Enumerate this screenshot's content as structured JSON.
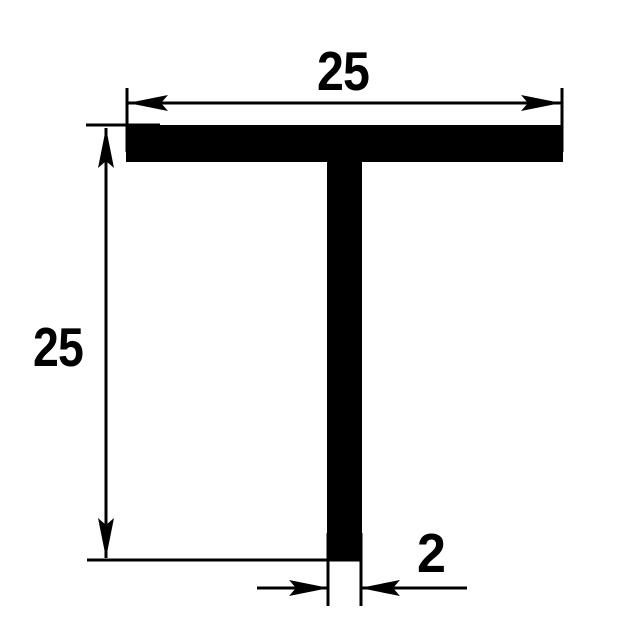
{
  "drawing": {
    "title": "T-profile cross-section technical drawing",
    "colors": {
      "ink": "#000000",
      "paper": "#ffffff"
    },
    "profile": {
      "shape": "T-section",
      "orientation": "flange on top, stem down"
    },
    "dimensions": {
      "width": {
        "label": "25",
        "position": "top"
      },
      "height": {
        "label": "25",
        "position": "left"
      },
      "thickness": {
        "label": "2",
        "position": "bottom-right"
      }
    }
  }
}
